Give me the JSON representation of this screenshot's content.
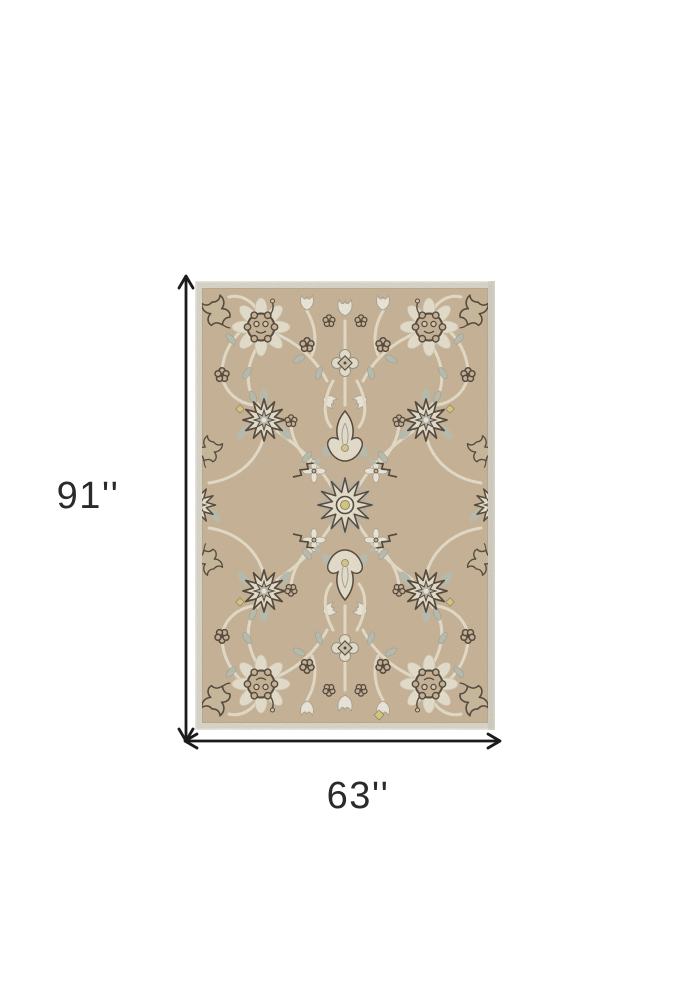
{
  "product": {
    "alt": "Beige and ivory Persian-style floral area rug shown flat"
  },
  "dimensions": {
    "height_label": "91''",
    "width_label": "63''"
  },
  "colors": {
    "page_bg": "#ffffff",
    "field": "#c8b397",
    "border_band": "#dbd8ce",
    "pattern_cream": "#e8e2d0",
    "pattern_white": "#eeebdf",
    "pattern_gray": "#b3b1a8",
    "leaf_gray": "#b8beb1",
    "outline_dark": "#4b4034",
    "accent_yellow": "#d8c97d",
    "vine_cream": "#e7e0cc",
    "dimension_line": "#1b1b1b",
    "label_text": "#2a2a2a"
  }
}
